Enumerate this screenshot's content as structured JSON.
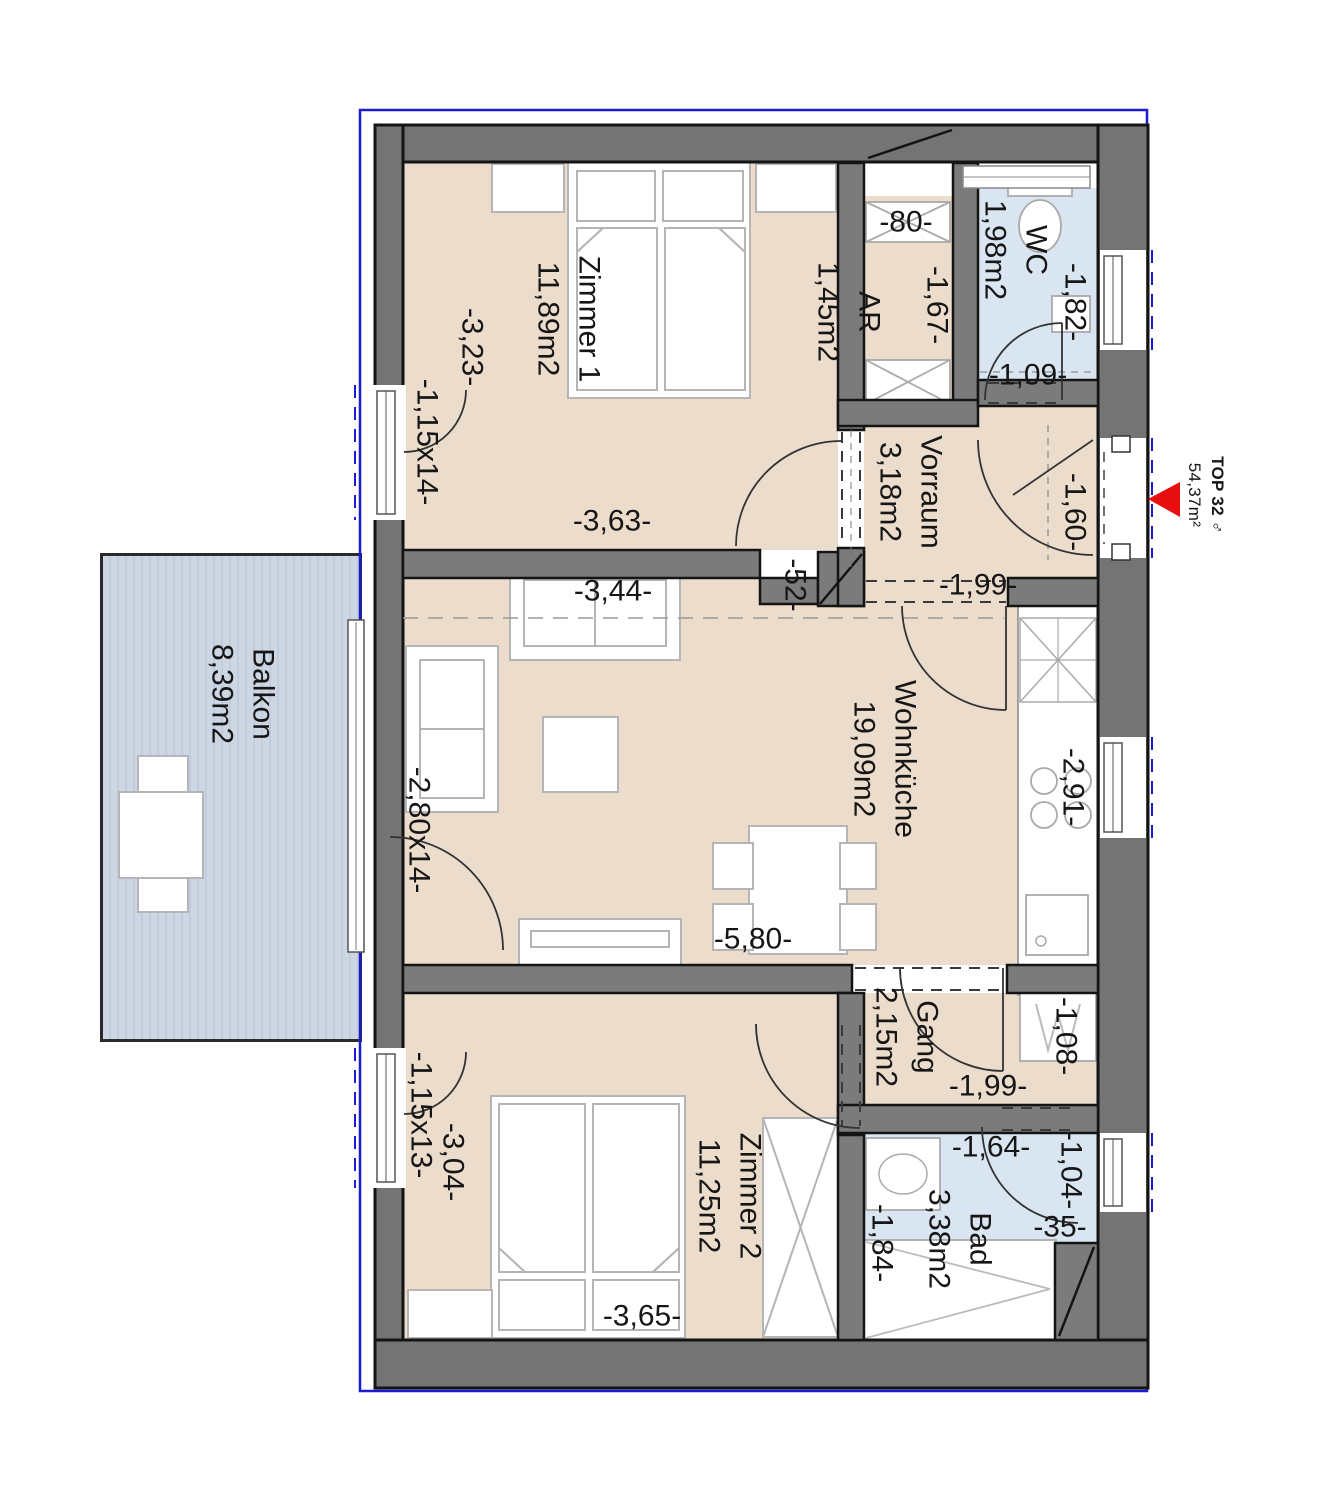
{
  "unit": {
    "name": "TOP 32 ♂",
    "area": "54,37m²"
  },
  "rooms": [
    {
      "id": "zimmer1",
      "name": "Zimmer 1",
      "area": "11,89m2"
    },
    {
      "id": "wc",
      "name": "WC",
      "area": "1,98m2"
    },
    {
      "id": "ar",
      "name": "AR",
      "area": "1,45m2"
    },
    {
      "id": "vorraum",
      "name": "Vorraum",
      "area": "3,18m2"
    },
    {
      "id": "wohnkueche",
      "name": "Wohnküche",
      "area": "19,09m2"
    },
    {
      "id": "balkon",
      "name": "Balkon",
      "area": "8,39m2"
    },
    {
      "id": "gang",
      "name": "Gang",
      "area": "2,15m2"
    },
    {
      "id": "zimmer2",
      "name": "Zimmer 2",
      "area": "11,25m2"
    },
    {
      "id": "bad",
      "name": "Bad",
      "area": "3,38m2"
    }
  ],
  "dims": [
    {
      "text": "-3,23-"
    },
    {
      "text": "-1,15x14-"
    },
    {
      "text": "-3,63-"
    },
    {
      "text": "-80-"
    },
    {
      "text": "-1,67-"
    },
    {
      "text": "-1,82-"
    },
    {
      "text": "-1,09-"
    },
    {
      "text": "-1,60-"
    },
    {
      "text": "-1,99-"
    },
    {
      "text": "-3,44-"
    },
    {
      "text": "-52-"
    },
    {
      "text": "-2,80x14-"
    },
    {
      "text": "-2,91-"
    },
    {
      "text": "-5,80-"
    },
    {
      "text": "-1,08-"
    },
    {
      "text": "-1,99-"
    },
    {
      "text": "-1,15x13-"
    },
    {
      "text": "-3,04-"
    },
    {
      "text": "-3,65-"
    },
    {
      "text": "-1,64-"
    },
    {
      "text": "-1,04-"
    },
    {
      "text": "-35-"
    },
    {
      "text": "-1,84-"
    }
  ],
  "colors": {
    "wall": "#747474",
    "partition": "#7b7b7b",
    "floor": "#ecdccb",
    "wet_room": "#d9e6f2",
    "balcony": "#cdd6e3",
    "boundary_line": "#1b1bd0",
    "entrance_marker": "#e60e0e",
    "furniture_line": "#b5b5b5"
  }
}
